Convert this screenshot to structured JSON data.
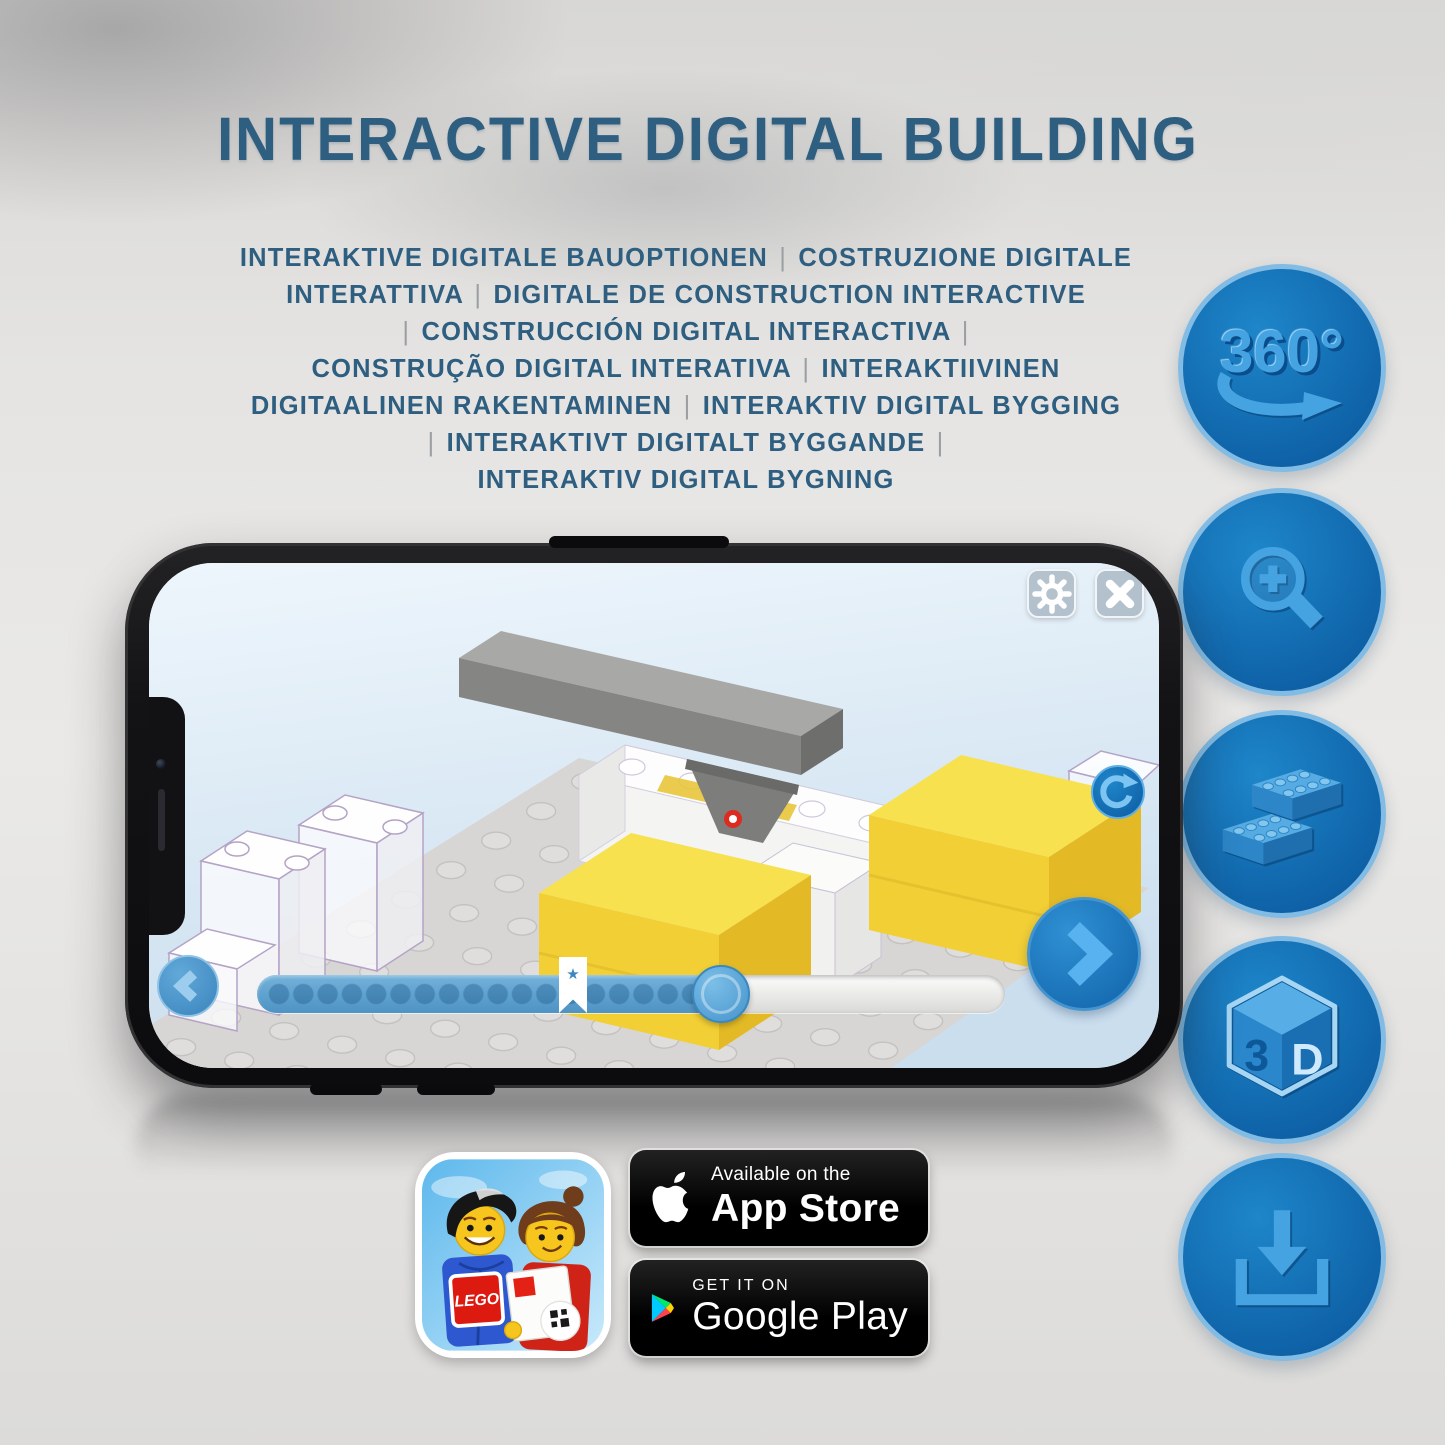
{
  "title": "INTERACTIVE DIGITAL BUILDING",
  "subtitle_lines": [
    "INTERAKTIVE DIGITALE BAUOPTIONEN | COSTRUZIONE DIGITALE",
    "INTERATTIVA | DIGITALE DE CONSTRUCTION INTERACTIVE",
    "| CONSTRUCCIÓN DIGITAL INTERACTIVA |",
    "CONSTRUÇÃO DIGITAL INTERATIVA | INTERAKTIIVINEN",
    "DIGITAALINEN RAKENTAMINEN | INTERAKTIV DIGITAL BYGGING",
    "| INTERAKTIVT DIGITALT BYGGANDE |",
    "INTERAKTIV DIGITAL BYGNING"
  ],
  "accent_colors": {
    "heading": "#2e5e80",
    "icon_circle_fill": "#1176ba",
    "icon_circle_rim": "#82bce4",
    "icon_glyph": "#45a3e2",
    "phone_ui_blue": "#1b7ac0",
    "brick_yellow": "#f3d53d"
  },
  "feature_icons": {
    "items": [
      "360-rotation-icon",
      "zoom-in-icon",
      "lego-brick-icon",
      "3d-cube-icon",
      "download-icon"
    ],
    "rotate_360_label": "360°",
    "cube_face_left": "3",
    "cube_face_right": "D"
  },
  "phone_app": {
    "ui_icons": [
      "gear-icon",
      "close-icon",
      "rotate-reset-icon",
      "chevron-left-icon",
      "chevron-right-icon",
      "bookmark-star-icon"
    ],
    "progress_slider": {
      "fill_percent": 62,
      "step_dot_count": 19,
      "bookmark_star": "★"
    }
  },
  "store_badges": {
    "app_store": {
      "line1": "Available on the",
      "line2": "App Store"
    },
    "google_play": {
      "line1": "GET IT ON",
      "line2": "Google Play"
    }
  },
  "lego_app_icon": {
    "logo_text": "LEGO"
  }
}
